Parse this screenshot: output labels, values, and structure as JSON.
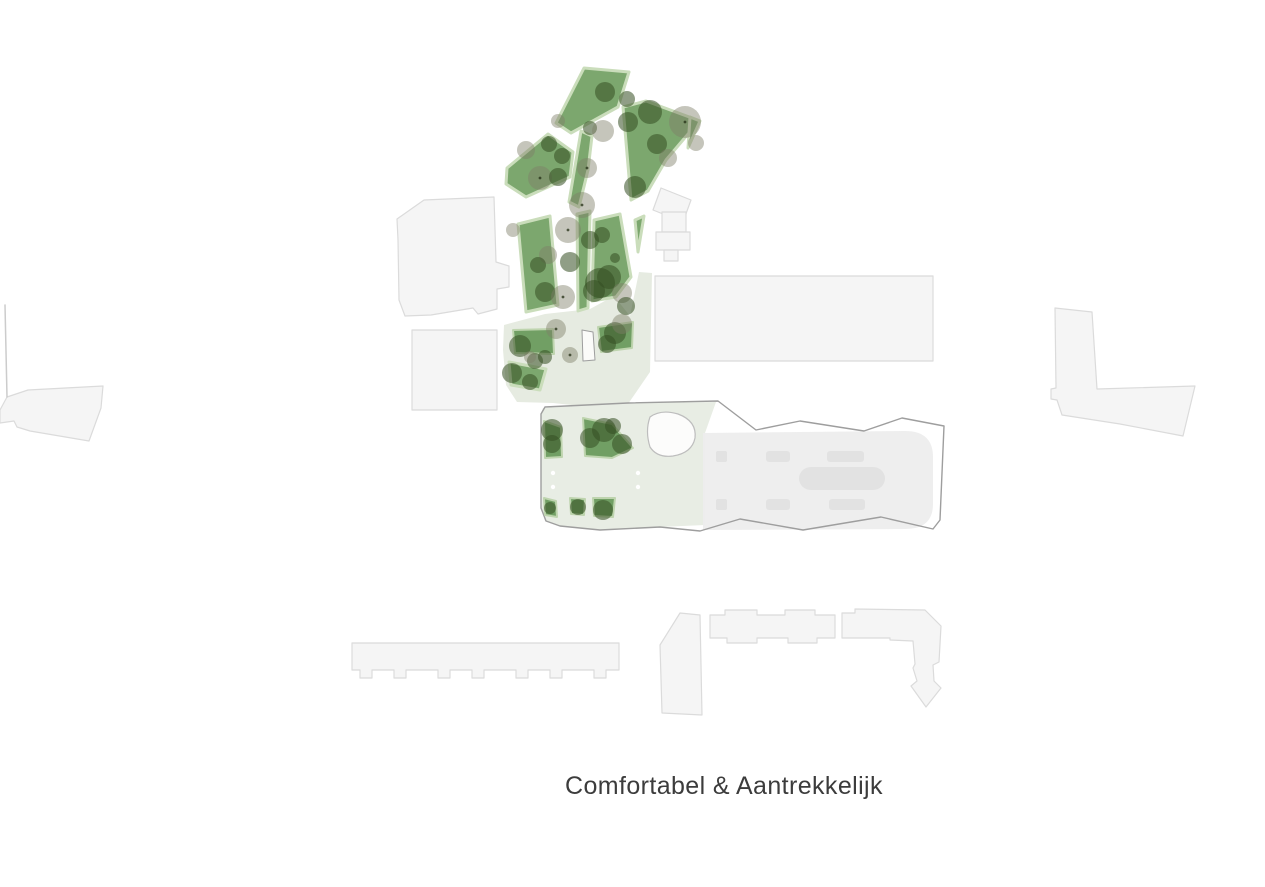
{
  "canvas": {
    "width": 1265,
    "height": 887,
    "background": "#ffffff"
  },
  "caption": {
    "text": "Comfortabel & Aantrekkelijk"
  },
  "colors": {
    "park_fill": "#7CA76E",
    "park_stroke": "#CADDBB",
    "garden_fill": "#719F64",
    "garden_stroke": "#BED4AE",
    "lawn_fill": "#E6EBE1",
    "plot_fill": "#E8EDE4",
    "footprint_fill": "#EDEDED",
    "footprint_detail": "#E2E2E2",
    "outline_stroke": "#9E9E9E",
    "building_fill": "#F5F5F5",
    "building_stroke": "#DBDBDB",
    "pond_fill": "#FCFCFB",
    "pond_stroke": "#BDBDBD",
    "plaza_fill": "#FBFBF9",
    "plaza_stroke": "#9E9E9E",
    "tree_dark": "rgba(52,78,34,0.55)",
    "tree_gray": "rgba(126,126,104,0.45)",
    "trunk_dot": "rgba(35,45,20,0.75)",
    "white_dot": "#FFFFFF",
    "boundary_line": "#CCCCCC",
    "caption_color": "#3C3C3C"
  },
  "styles": {
    "building": {
      "fill": "#F5F5F5",
      "stroke": "#DBDBDB",
      "sw": 1.2
    },
    "line": {
      "fill": "none",
      "stroke": "#CCCCCC",
      "sw": 1.5
    },
    "lawn": {
      "fill": "#E6EBE1",
      "stroke": "none",
      "sw": 0
    },
    "plot": {
      "fill": "#E8EDE4",
      "stroke": "none",
      "sw": 0
    },
    "footprint": {
      "fill": "#EDEDED",
      "stroke": "none",
      "sw": 0,
      "opacity": 0.95
    },
    "detail": {
      "fill": "#E2E2E2",
      "stroke": "none",
      "sw": 0
    },
    "outline": {
      "fill": "none",
      "stroke": "#9E9E9E",
      "sw": 1.4
    },
    "pond": {
      "fill": "#FCFCFB",
      "stroke": "#BDBDBD",
      "sw": 1.2
    },
    "plaza": {
      "fill": "#FBFBF9",
      "stroke": "#9E9E9E",
      "sw": 1
    },
    "garden": {
      "fill": "#719F64",
      "stroke": "#BED4AE",
      "sw": 2
    },
    "park": {
      "fill": "#7CA76E",
      "stroke": "#CADDBB",
      "sw": 3
    }
  },
  "map": {
    "layers": [
      {
        "kind": "building",
        "shapes": [
          {
            "name": "building-upper-left",
            "points": "398,240 397,219 424,200 494,197 496,262 509,266 509,287 497,289 497,309 478,314 473,308 431,315 405,316 399,300"
          },
          {
            "name": "building-upper-left-2",
            "points": "412,330 497,330 497,410 412,410"
          },
          {
            "name": "building-small-rotated",
            "points": "661,188 691,200 683,222 653,210"
          },
          {
            "name": "building-small-a",
            "points": "662,212 686,212 686,232 662,232"
          },
          {
            "name": "building-small-b",
            "points": "656,232 690,232 690,250 656,250"
          },
          {
            "name": "building-small-c",
            "points": "664,250 678,250 678,261 664,261"
          },
          {
            "name": "building-big-rect",
            "points": "655,276 933,276 933,361 655,361"
          },
          {
            "name": "building-right-l",
            "points": "1055,308 1092,312 1097,389 1195,386 1183,436 1120,424 1062,415 1057,400 1051,399 1051,389 1056,388"
          },
          {
            "name": "building-left-wedge",
            "points": "0,410 7,397 28,390 103,386 101,408 89,441 30,431 17,427 14,421 0,423"
          },
          {
            "name": "building-bottom-long",
            "points": "352,643 619,643 619,670 606,670 606,678 594,678 594,670 562,670 562,678 550,678 550,670 528,670 528,678 516,678 516,670 484,670 484,678 472,678 472,670 450,670 450,678 438,678 438,670 406,670 406,678 394,678 394,670 372,670 372,678 360,678 360,670 352,670"
          },
          {
            "name": "building-bottom-vertical",
            "points": "660,645 680,613 700,615 702,715 662,713"
          },
          {
            "name": "building-bottom-horizontal",
            "points": "710,615 725,615 725,610 757,610 757,615 785,615 785,610 815,610 815,615 835,615 835,638 817,638 817,643 788,643 788,638 757,638 757,643 727,643 727,638 710,638"
          },
          {
            "name": "building-bottom-l-arrow",
            "d": "M842,613 L855,613 L855,609 L925,610 L941,626 L939,662 L933,665 L934,681 L941,688 L926,707 L911,686 L917,681 L913,668 L915,664 L913,641 L890,640 L890,638 L842,638 Z"
          }
        ]
      },
      {
        "kind": "line",
        "shapes": [
          {
            "name": "boundary-line",
            "d": "M5,305 L7,397"
          }
        ]
      },
      {
        "kind": "lawn",
        "shapes": [
          {
            "name": "lawn-area",
            "points": "504,325 545,314 590,309 614,296 630,316 639,272 652,273 650,372 628,404 590,407 553,403 517,402 506,385 503,350"
          }
        ]
      },
      {
        "kind": "plot",
        "shapes": [
          {
            "name": "courtyard-plot",
            "points": "543,408 628,403 716,402 705,433 705,525 660,527 600,530 560,526 545,521 541,508 541,414"
          }
        ]
      },
      {
        "kind": "footprint",
        "shapes": [
          {
            "name": "building-footprint-fill",
            "d": "M703,433 L905,431 Q933,431 933,457 L933,504 Q933,529 905,529 L703,530 Z"
          }
        ]
      },
      {
        "kind": "detail",
        "shapes": [
          {
            "name": "roof-detail",
            "x": 716,
            "y": 451,
            "w": 11,
            "h": 11,
            "rx": 2
          },
          {
            "name": "roof-detail",
            "x": 766,
            "y": 451,
            "w": 24,
            "h": 11,
            "rx": 3
          },
          {
            "name": "roof-detail",
            "x": 827,
            "y": 451,
            "w": 37,
            "h": 11,
            "rx": 3
          },
          {
            "name": "roof-detail",
            "x": 716,
            "y": 499,
            "w": 11,
            "h": 11,
            "rx": 2
          },
          {
            "name": "roof-detail",
            "x": 766,
            "y": 499,
            "w": 24,
            "h": 11,
            "rx": 3
          },
          {
            "name": "roof-detail",
            "x": 829,
            "y": 499,
            "w": 36,
            "h": 11,
            "rx": 3
          },
          {
            "name": "roof-detail-pill",
            "x": 799,
            "y": 467,
            "w": 86,
            "h": 23,
            "rx": 12
          }
        ]
      },
      {
        "kind": "outline",
        "shapes": [
          {
            "name": "plot-building-outline",
            "d": "M545,407 L628,403 L718,401 L756,430 L800,421 L864,431 L902,418 L944,426 L940,520 L933,529 L881,517 L803,530 L740,519 L700,531 L660,527 L600,530 L560,526 L546,521 L541,508 L541,414 Z"
          }
        ]
      },
      {
        "kind": "pond",
        "shapes": [
          {
            "name": "pond",
            "d": "M650,417 Q661,409 678,414 Q697,421 695,438 Q692,453 673,456 Q657,458 650,447 Q645,431 650,417 Z"
          }
        ]
      },
      {
        "kind": "plaza",
        "shapes": [
          {
            "name": "plaza-pad",
            "points": "582,330 593,332 595,360 583,361"
          }
        ]
      },
      {
        "kind": "garden",
        "shapes": [
          {
            "name": "garden-bed",
            "points": "513,330 553,329 554,354 515,353"
          },
          {
            "name": "garden-bed",
            "points": "598,327 633,322 632,348 601,352"
          },
          {
            "name": "garden-bed",
            "points": "544,421 561,427 562,457 545,458"
          },
          {
            "name": "garden-bed",
            "points": "583,418 612,424 633,448 612,458 585,456"
          },
          {
            "name": "garden-bed",
            "points": "544,498 556,501 557,517 545,515"
          },
          {
            "name": "garden-bed",
            "points": "570,498 585,499 584,515 571,514"
          },
          {
            "name": "garden-bed",
            "points": "593,498 615,498 613,517 594,516"
          }
        ]
      },
      {
        "kind": "park",
        "shapes": [
          {
            "name": "park-polygon",
            "points": "584,68 629,72 618,107 571,133 556,123"
          },
          {
            "name": "park-polygon",
            "points": "507,168 548,134 573,152 570,177 526,197 506,184"
          },
          {
            "name": "park-polygon",
            "points": "581,131 592,136 588,170 579,207 569,202"
          },
          {
            "name": "park-polygon",
            "points": "623,107 646,101 692,118 694,127 666,160 648,191 631,200"
          },
          {
            "name": "park-polygon",
            "points": "690,117 700,121 688,148"
          },
          {
            "name": "park-polygon",
            "points": "518,224 550,216 558,305 526,312"
          },
          {
            "name": "park-polygon",
            "points": "577,214 590,211 588,308 578,311"
          },
          {
            "name": "park-polygon",
            "points": "594,220 620,214 631,277 616,297 592,301"
          },
          {
            "name": "park-polygon",
            "points": "635,220 644,216 638,252"
          },
          {
            "name": "park-polygon",
            "points": "509,362 546,369 540,390 511,385"
          }
        ]
      }
    ],
    "trees": [
      {
        "x": 605,
        "y": 92,
        "r": 10,
        "t": "dark"
      },
      {
        "x": 627,
        "y": 99,
        "r": 8,
        "t": "dark"
      },
      {
        "x": 558,
        "y": 121,
        "r": 7,
        "t": "gray"
      },
      {
        "x": 590,
        "y": 128,
        "r": 7,
        "t": "dark"
      },
      {
        "x": 603,
        "y": 131,
        "r": 11,
        "t": "gray"
      },
      {
        "x": 650,
        "y": 112,
        "r": 12,
        "t": "dark"
      },
      {
        "x": 628,
        "y": 122,
        "r": 10,
        "t": "dark"
      },
      {
        "x": 685,
        "y": 122,
        "r": 16,
        "t": "gray",
        "dot": true
      },
      {
        "x": 657,
        "y": 144,
        "r": 10,
        "t": "dark"
      },
      {
        "x": 696,
        "y": 143,
        "r": 8,
        "t": "gray"
      },
      {
        "x": 526,
        "y": 150,
        "r": 9,
        "t": "gray"
      },
      {
        "x": 549,
        "y": 144,
        "r": 8,
        "t": "dark"
      },
      {
        "x": 562,
        "y": 156,
        "r": 8,
        "t": "dark"
      },
      {
        "x": 587,
        "y": 168,
        "r": 10,
        "t": "gray",
        "dot": true
      },
      {
        "x": 540,
        "y": 178,
        "r": 12,
        "t": "gray",
        "dot": true
      },
      {
        "x": 558,
        "y": 177,
        "r": 9,
        "t": "dark"
      },
      {
        "x": 668,
        "y": 158,
        "r": 9,
        "t": "gray"
      },
      {
        "x": 635,
        "y": 187,
        "r": 11,
        "t": "dark"
      },
      {
        "x": 582,
        "y": 205,
        "r": 13,
        "t": "gray",
        "dot": true
      },
      {
        "x": 568,
        "y": 230,
        "r": 13,
        "t": "gray",
        "dot": true
      },
      {
        "x": 513,
        "y": 230,
        "r": 7,
        "t": "gray"
      },
      {
        "x": 590,
        "y": 240,
        "r": 9,
        "t": "dark"
      },
      {
        "x": 602,
        "y": 235,
        "r": 8,
        "t": "dark"
      },
      {
        "x": 548,
        "y": 255,
        "r": 9,
        "t": "gray"
      },
      {
        "x": 538,
        "y": 265,
        "r": 8,
        "t": "dark"
      },
      {
        "x": 570,
        "y": 262,
        "r": 10,
        "t": "dark"
      },
      {
        "x": 615,
        "y": 258,
        "r": 5,
        "t": "dark"
      },
      {
        "x": 545,
        "y": 292,
        "r": 10,
        "t": "dark"
      },
      {
        "x": 563,
        "y": 297,
        "r": 12,
        "t": "gray",
        "dot": true
      },
      {
        "x": 600,
        "y": 283,
        "r": 15,
        "t": "dark"
      },
      {
        "x": 609,
        "y": 277,
        "r": 12,
        "t": "dark"
      },
      {
        "x": 594,
        "y": 291,
        "r": 11,
        "t": "dark"
      },
      {
        "x": 622,
        "y": 293,
        "r": 10,
        "t": "gray"
      },
      {
        "x": 626,
        "y": 306,
        "r": 9,
        "t": "dark"
      },
      {
        "x": 556,
        "y": 329,
        "r": 10,
        "t": "gray",
        "dot": true
      },
      {
        "x": 520,
        "y": 346,
        "r": 11,
        "t": "dark"
      },
      {
        "x": 535,
        "y": 361,
        "r": 8,
        "t": "dark"
      },
      {
        "x": 545,
        "y": 357,
        "r": 7,
        "t": "dark"
      },
      {
        "x": 530,
        "y": 357,
        "r": 6,
        "t": "gray"
      },
      {
        "x": 570,
        "y": 355,
        "r": 8,
        "t": "gray",
        "dot": true
      },
      {
        "x": 615,
        "y": 333,
        "r": 11,
        "t": "dark"
      },
      {
        "x": 607,
        "y": 344,
        "r": 9,
        "t": "dark"
      },
      {
        "x": 622,
        "y": 324,
        "r": 10,
        "t": "gray"
      },
      {
        "x": 512,
        "y": 373,
        "r": 10,
        "t": "dark"
      },
      {
        "x": 530,
        "y": 382,
        "r": 8,
        "t": "dark"
      },
      {
        "x": 552,
        "y": 430,
        "r": 11,
        "t": "dark"
      },
      {
        "x": 552,
        "y": 444,
        "r": 9,
        "t": "dark"
      },
      {
        "x": 590,
        "y": 438,
        "r": 10,
        "t": "dark"
      },
      {
        "x": 604,
        "y": 430,
        "r": 12,
        "t": "dark"
      },
      {
        "x": 622,
        "y": 444,
        "r": 10,
        "t": "dark"
      },
      {
        "x": 613,
        "y": 426,
        "r": 8,
        "t": "dark"
      },
      {
        "x": 550,
        "y": 508,
        "r": 6,
        "t": "dark"
      },
      {
        "x": 578,
        "y": 507,
        "r": 8,
        "t": "dark"
      },
      {
        "x": 603,
        "y": 510,
        "r": 10,
        "t": "dark"
      }
    ],
    "white_dots": [
      {
        "x": 553,
        "y": 473
      },
      {
        "x": 553,
        "y": 487
      },
      {
        "x": 638,
        "y": 473
      },
      {
        "x": 638,
        "y": 487
      }
    ]
  }
}
